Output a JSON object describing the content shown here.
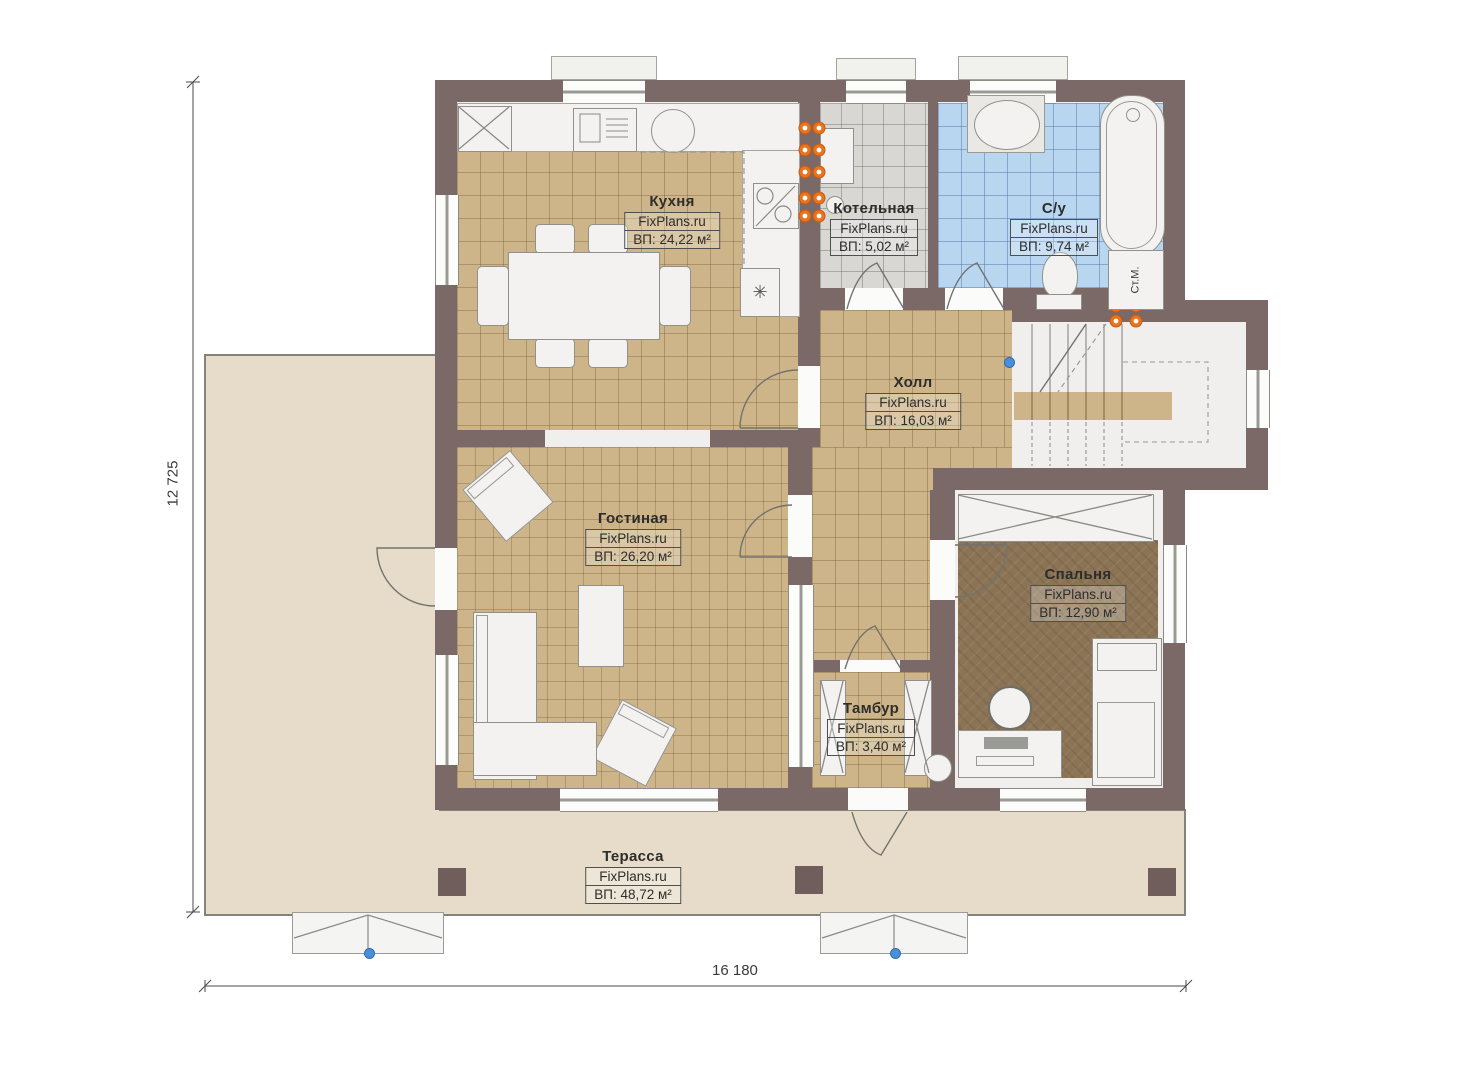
{
  "watermark": "FixPlans.ru",
  "rooms": [
    {
      "name": "Кухня",
      "brand": "FixPlans.ru",
      "area": "ВП: 24,22 м²"
    },
    {
      "name": "Котельная",
      "brand": "FixPlans.ru",
      "area": "ВП: 5,02 м²"
    },
    {
      "name": "С/у",
      "brand": "FixPlans.ru",
      "area": "ВП: 9,74 м²"
    },
    {
      "name": "Холл",
      "brand": "FixPlans.ru",
      "area": "ВП: 16,03 м²"
    },
    {
      "name": "Гостиная",
      "brand": "FixPlans.ru",
      "area": "ВП: 26,20 м²"
    },
    {
      "name": "Спальня",
      "brand": "FixPlans.ru",
      "area": "ВП: 12,90 м²"
    },
    {
      "name": "Тамбур",
      "brand": "FixPlans.ru",
      "area": "ВП: 3,40 м²"
    },
    {
      "name": "Терасса",
      "brand": "FixPlans.ru",
      "area": "ВП: 48,72 м²"
    }
  ],
  "dimensions": {
    "left": "12 725",
    "bottom": "16 180"
  },
  "labels": {
    "washing_machine": "Ст.М.",
    "cooktop_symbol": "✳"
  },
  "colors": {
    "wall": "#7b6967",
    "terrace": "#e7dcc9",
    "tile_tan": "#cdb489",
    "tile_gray": "#d8d7d4",
    "tile_blue": "#b9d6f1",
    "carpet": "#8b7355",
    "radiator": "#e9731f",
    "marker_blue": "#4a90d9"
  }
}
